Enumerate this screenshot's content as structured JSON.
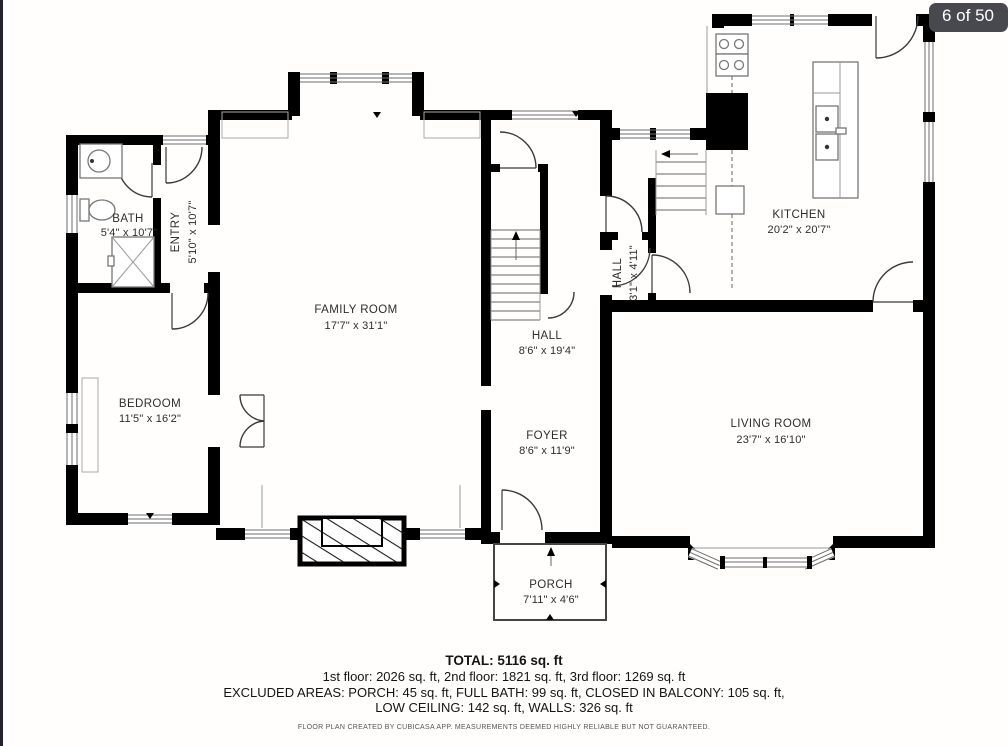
{
  "viewer": {
    "badge": "6 of 50"
  },
  "rooms": [
    {
      "name": "BATH",
      "dims": "5'4\" x 10'7\""
    },
    {
      "name": "ENTRY",
      "dims": "5'10\" x 10'7\""
    },
    {
      "name": "FAMILY ROOM",
      "dims": "17'7\" x 31'1\""
    },
    {
      "name": "HALL",
      "dims": "8'6\" x 19'4\""
    },
    {
      "name": "KITCHEN",
      "dims": "20'2\" x 20'7\""
    },
    {
      "name": "HALL",
      "dims": "3'1\" x 4'11\""
    },
    {
      "name": "BEDROOM",
      "dims": "11'5\" x 16'2\""
    },
    {
      "name": "FOYER",
      "dims": "8'6\" x 11'9\""
    },
    {
      "name": "LIVING ROOM",
      "dims": "23'7\" x 16'10\""
    },
    {
      "name": "PORCH",
      "dims": "7'11\" x 4'6\""
    }
  ],
  "summary": {
    "total": "TOTAL: 5116 sq. ft",
    "floors": "1st floor: 2026 sq. ft, 2nd floor: 1821 sq. ft, 3rd floor: 1269 sq. ft",
    "excluded": "EXCLUDED AREAS: PORCH: 45 sq. ft, FULL BATH: 99 sq. ft, CLOSED IN BALCONY: 105 sq. ft,",
    "excluded2": "LOW CEILING: 142 sq. ft, WALLS: 326 sq. ft",
    "disclaimer": "FLOOR PLAN CREATED BY CUBICASA APP. MEASUREMENTS DEEMED HIGHLY RELIABLE BUT NOT GUARANTEED."
  },
  "colors": {
    "wall": "#000000",
    "badge_bg": "#48484f",
    "label_text": "#2d2d2d"
  }
}
